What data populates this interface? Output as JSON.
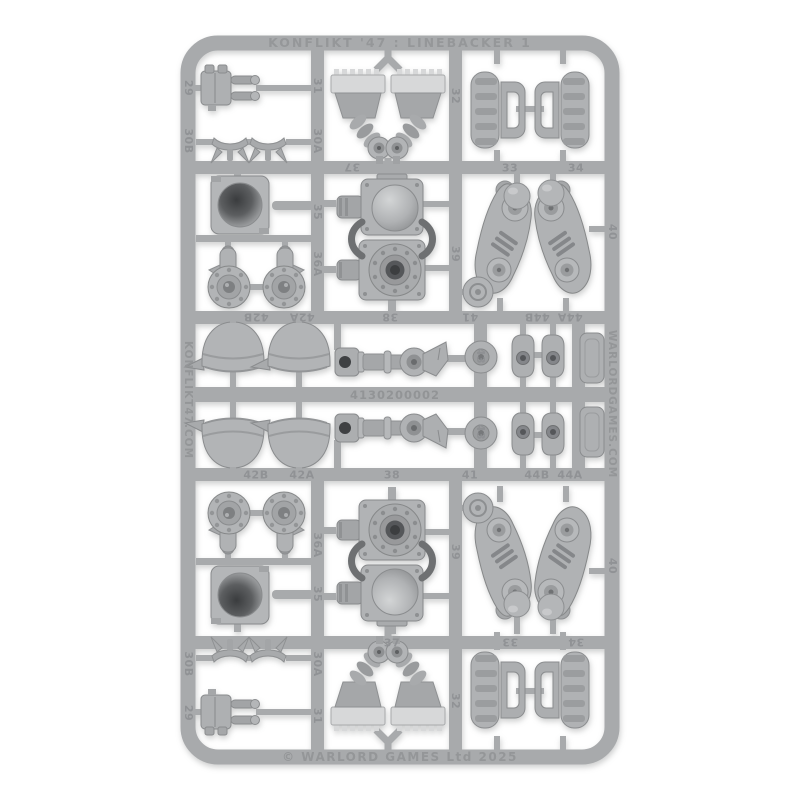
{
  "object": {
    "title": "KONFLIKT '47 : LINEBACKER 1",
    "copyright": "© WARLORD GAMES Ltd 2025",
    "left_rail_url": "KONFLIKT47.COM",
    "right_rail_url": "WARLORDGAMES.COM",
    "mold_code": "4130200002"
  },
  "part_numbers": {
    "n29": "29",
    "n30A": "30A",
    "n30B": "30B",
    "n31": "31",
    "n32": "32",
    "n33": "33",
    "n34": "34",
    "n35": "35",
    "n36A": "36A",
    "n37": "37",
    "n38": "38",
    "n39": "39",
    "n40": "40",
    "n41": "41",
    "n42A": "42A",
    "n42B": "42B",
    "n43": "43",
    "n44A": "44A",
    "n44B": "44B"
  },
  "colors": {
    "background": "#ffffff",
    "plastic_rail": "#a8aaac",
    "plastic_part": "#b0b2b4",
    "plastic_edge": "#8a8c8e",
    "plastic_light": "#d7d8d9",
    "plastic_dark_hole": "#3f4143"
  }
}
